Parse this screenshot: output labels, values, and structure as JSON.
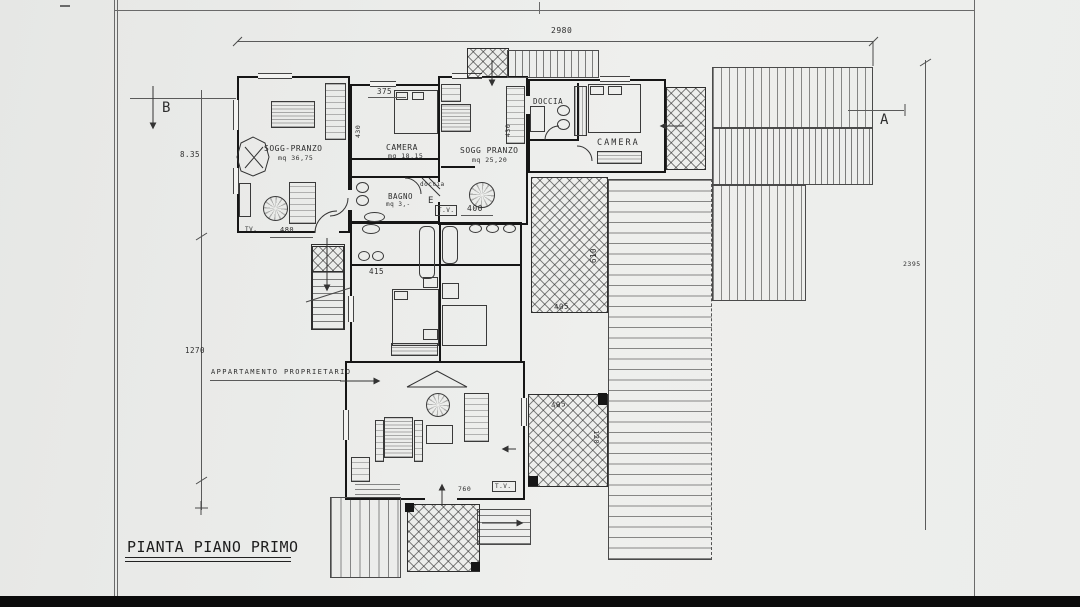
{
  "drawing": {
    "title": "PIANTA PIANO PRIMO",
    "apartment_note": "APPARTAMENTO PROPRIETARIO",
    "markers": {
      "a": "A",
      "b": "B",
      "e": "E"
    },
    "tv": "T.V.",
    "tv_short": "TV.",
    "rooms": {
      "sogg_main": {
        "label": "SOGG-PRANZO",
        "area": "mq 36,75"
      },
      "camera_small": {
        "label": "CAMERA",
        "area": "mq 18,15"
      },
      "sogg_guest": {
        "label": "SOGG PRANZO",
        "area": "mq 25,20"
      },
      "bagno": {
        "label": "BAGNO",
        "area": "mq 3,-",
        "note": "doccia"
      },
      "doccia": {
        "label": "DOCCIA"
      },
      "camera_guest": {
        "label": "CAMERA"
      }
    },
    "dimensions": {
      "top": "2980",
      "left_upper": "8.35",
      "left_lower": "1270",
      "right": "2395",
      "w375": "375",
      "h430_left": "430",
      "h430_right": "430",
      "w400": "400",
      "w480": "480",
      "w415": "415",
      "h610": "610",
      "w405_upper": "405",
      "w405_lower": "405",
      "h120": "120",
      "w760": "760"
    },
    "colors": {
      "paper": "#ecedeb",
      "ink": "#2e2e2e",
      "wall": "#161616"
    }
  }
}
